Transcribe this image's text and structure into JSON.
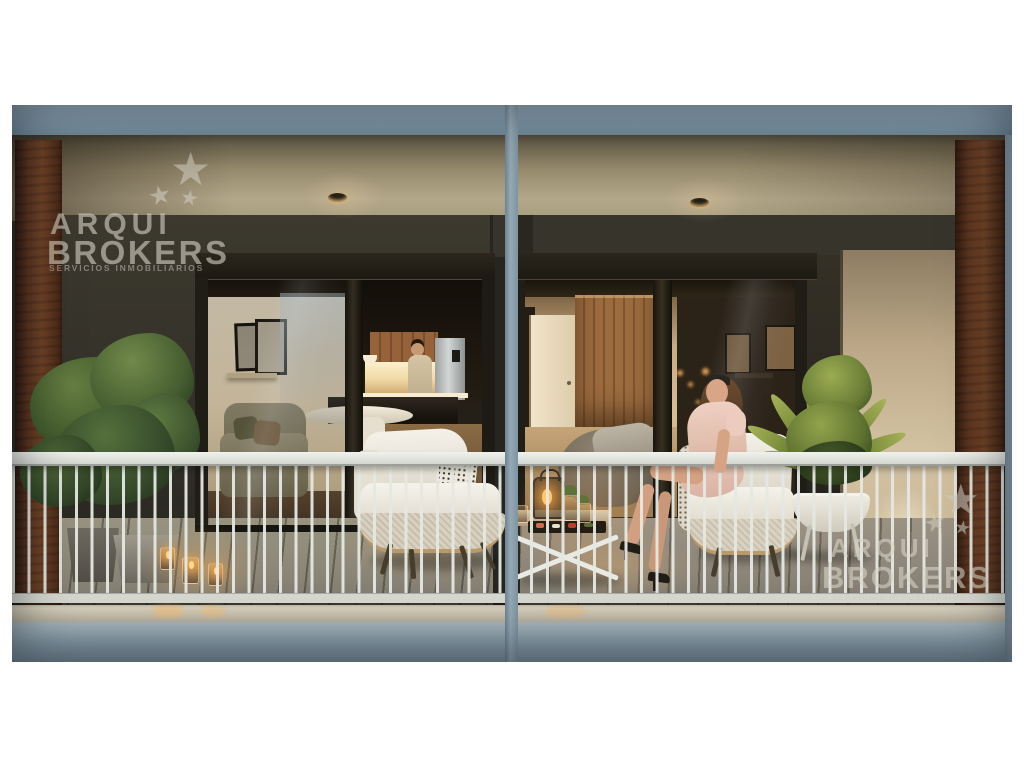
{
  "watermark": {
    "star": "★",
    "brand_top": "ARQUI",
    "brand_bottom": "BROKERS",
    "tagline": "SERVICIOS INMOBILIARIOS",
    "color": "#d8d3c7"
  },
  "palette": {
    "page_margin": "#ffffff",
    "concrete_slab_blue_grey": "#8ba0ac",
    "soffit_beige": "#b3a78a",
    "facade_dark_olive": "#34312a",
    "corten_rust_pillar": "#6f4327",
    "railing_white": "#e5e8e2",
    "interior_warm_glow": "#f0d9a6",
    "candle_flame": "#ffc870",
    "foliage_green": "#5e7a40",
    "palm_green": "#7f9140",
    "armchair_white": "#f3f0e8",
    "dress_pink": "#eed0c2",
    "frosted_screen_beige": "#d2c1a1",
    "balcony_floor_grey": "#8e867a"
  },
  "scene": {
    "description": "Twilight architectural rendering of two adjacent apartment balconies separated by a blue-grey concrete pillar, with white vertical-bar railings, rust corten side pillars and recessed ceiling downlights.",
    "left_unit": "Open living-kitchen interior seen through sliding glass doors: man at a lit counter, shelf with framed pictures, sofa, round white dining table; balcony holds a leafy potted plant, candle lanterns on the floor and a white lounge chair with dotted cushion.",
    "right_unit": "Interior with timber wardrobe, open cream door and grey pouf; on the balcony a woman in a pink dress sits on a white lounge chair beside a low table with a lantern and snacks, next to a potted palm on a white stand and a frosted glass privacy screen."
  }
}
